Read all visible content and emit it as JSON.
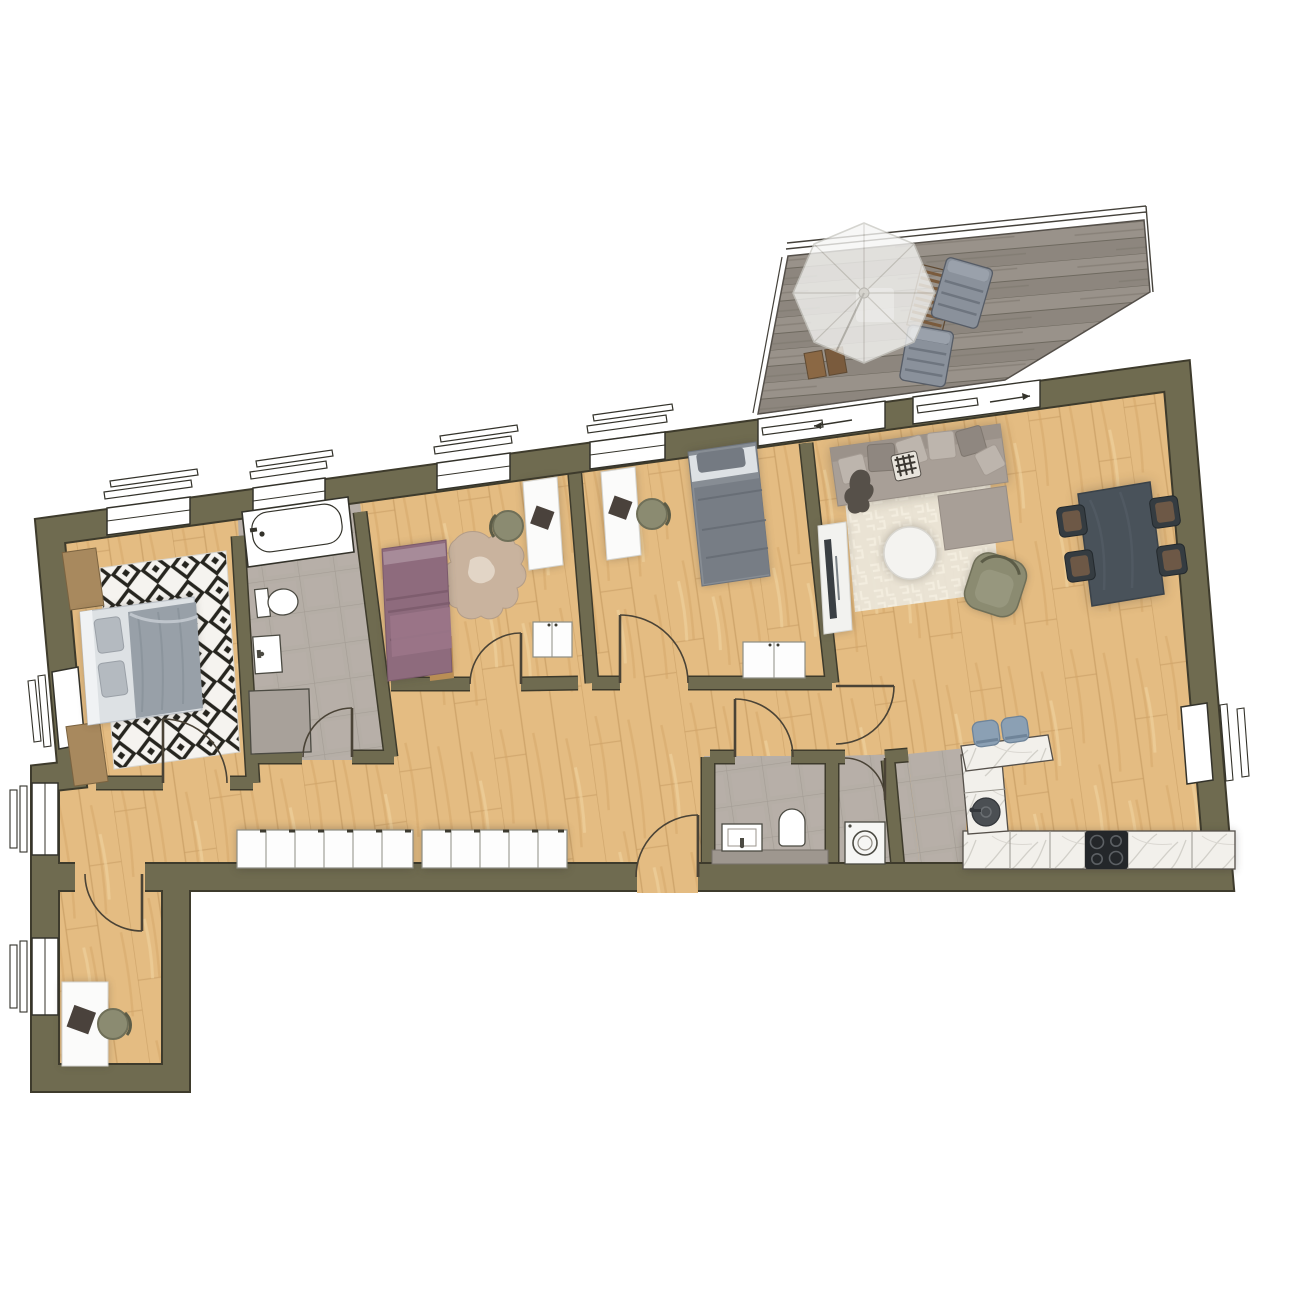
{
  "document": {
    "type": "floor-plan",
    "view": "top-down apartment plan with furniture, no text labels"
  },
  "colors": {
    "bg": "#ffffff",
    "wall": "#6f6b50",
    "wallEdge": "#3e3b2c",
    "woodBase": "#e4bc82",
    "woodLineA": "#c89d63",
    "woodLineB": "#f0d3a0",
    "tileBase": "#b5aea6",
    "tileLine": "#a49d95",
    "deckBase": "#99928a",
    "deckAlt": "#8d867e",
    "deckLine": "#6e695f",
    "windowWhite": "#ffffff",
    "frameDark": "#33322a",
    "doorArc": "#4a4336",
    "rugWhite": "#f5f3ef",
    "rugBlack": "#26251f",
    "livingRug": "#eae5d8",
    "sofa": "#a89f97",
    "sofaPillowLight": "#bdb5ad",
    "sofaPillowDark": "#8f8780",
    "sofaThrow": "#565049",
    "coffeeTable": "#f4f3f0",
    "armchairOlive": "#8b8b71",
    "tvConsole": "#f2f2ef",
    "tvDark": "#3a3f43",
    "diningTable": "#49525a",
    "diningChair": "#353c41",
    "chairSeatBrown": "#6d5846",
    "bedGray": "#878d94",
    "bedGrayDark": "#747a82",
    "beddingLight": "#dde1e4",
    "pillowGray": "#b4bac0",
    "blanketGray": "#98a0a8",
    "bedPurple": "#8e6b7d",
    "bedPurpleLight": "#a78b99",
    "bedFootTan": "#b98e55",
    "nightstand": "#a8895e",
    "deskWhite": "#fbfbfa",
    "laptopDark": "#4a423c",
    "wardrobeWhite": "#fdfdfd",
    "wardrobeLine": "#8d8d84",
    "marble": "#f2f0eb",
    "marbleVein": "#cfccc6",
    "cooktop": "#24272a",
    "burner": "#5c6064",
    "sinkDark": "#4b4f53",
    "stoolBlue": "#8ba0b4",
    "washerWhite": "#f6f6f4",
    "hideRug": "#c9b39e",
    "hideRugLight": "#e8ddd0",
    "parasol": "#f6f6f4",
    "lounger": "#8a919b",
    "loungerDark": "#6e757f",
    "deckWood": "#7a5b3d",
    "showerGray": "#a8a19a",
    "fixtureWhite": "#ffffff",
    "shadow": "#2b2416"
  },
  "counts": {
    "hall_wardrobe_doors_left": 6,
    "hall_wardrobe_doors_right": 5,
    "dining_chairs": 4,
    "cooktop_burners": 4,
    "terrace_loungers": 2,
    "kitchen_bar_stools": 2,
    "desks": 3,
    "north_windows": 4,
    "sliding_terrace_doors": 2
  },
  "rooms": [
    {
      "id": "master-bedroom",
      "furniture": [
        "double-bed",
        "nightstand",
        "dresser",
        "diamond-rug",
        "window"
      ]
    },
    {
      "id": "bathroom",
      "furniture": [
        "bathtub",
        "toilet",
        "washbasin",
        "shower"
      ]
    },
    {
      "id": "bedroom-2",
      "furniture": [
        "single-bed-purple",
        "hide-rug",
        "desk",
        "desk-chair",
        "cabinet"
      ]
    },
    {
      "id": "bedroom-3",
      "furniture": [
        "single-bed-gray",
        "desk",
        "desk-chair",
        "cabinet"
      ]
    },
    {
      "id": "living-room",
      "furniture": [
        "corner-sofa",
        "coffee-table",
        "area-rug",
        "armchair",
        "tv-console",
        "dining-table",
        "dining-chairs"
      ]
    },
    {
      "id": "kitchen",
      "furniture": [
        "counter-run",
        "cooktop",
        "round-sink",
        "peninsula",
        "bar-stools"
      ]
    },
    {
      "id": "wc",
      "furniture": [
        "washbasin",
        "toilet"
      ]
    },
    {
      "id": "utility-room",
      "furniture": [
        "washing-machine"
      ]
    },
    {
      "id": "hallway",
      "furniture": [
        "wardrobe-row-left",
        "wardrobe-row-right"
      ]
    },
    {
      "id": "office-nook",
      "furniture": [
        "desk",
        "desk-chair",
        "window"
      ]
    },
    {
      "id": "terrace",
      "furniture": [
        "parasol",
        "lounge-chairs",
        "slat-table",
        "folding-table",
        "railing"
      ]
    }
  ]
}
